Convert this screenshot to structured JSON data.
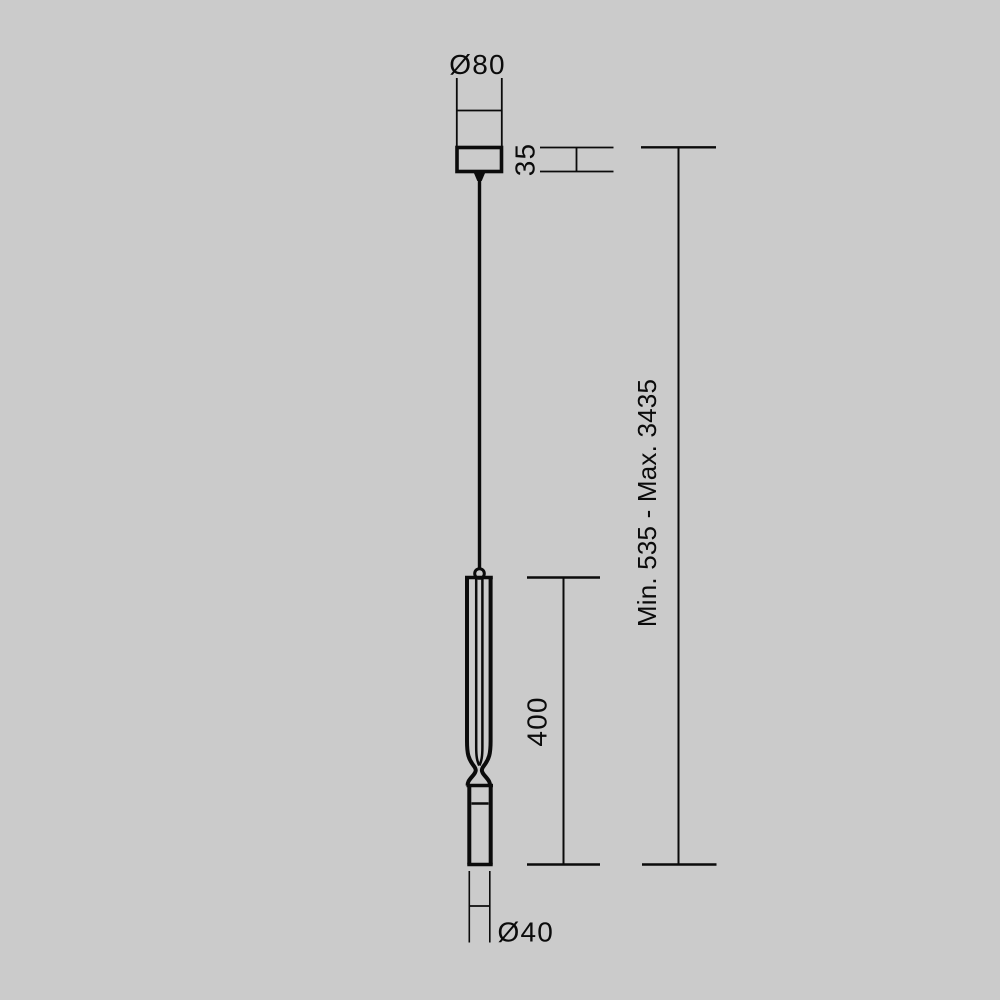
{
  "page": {
    "background_color": "#cbcbcb",
    "line_color": "#0b0b0b",
    "description": "Technical dimension drawing of a single-cable pendant lamp"
  },
  "labels": {
    "canopy_diameter": "Ø80",
    "canopy_height": "35",
    "suspension_range": "Min. 535 - Max. 3435",
    "body_length": "400",
    "body_diameter": "Ø40"
  }
}
